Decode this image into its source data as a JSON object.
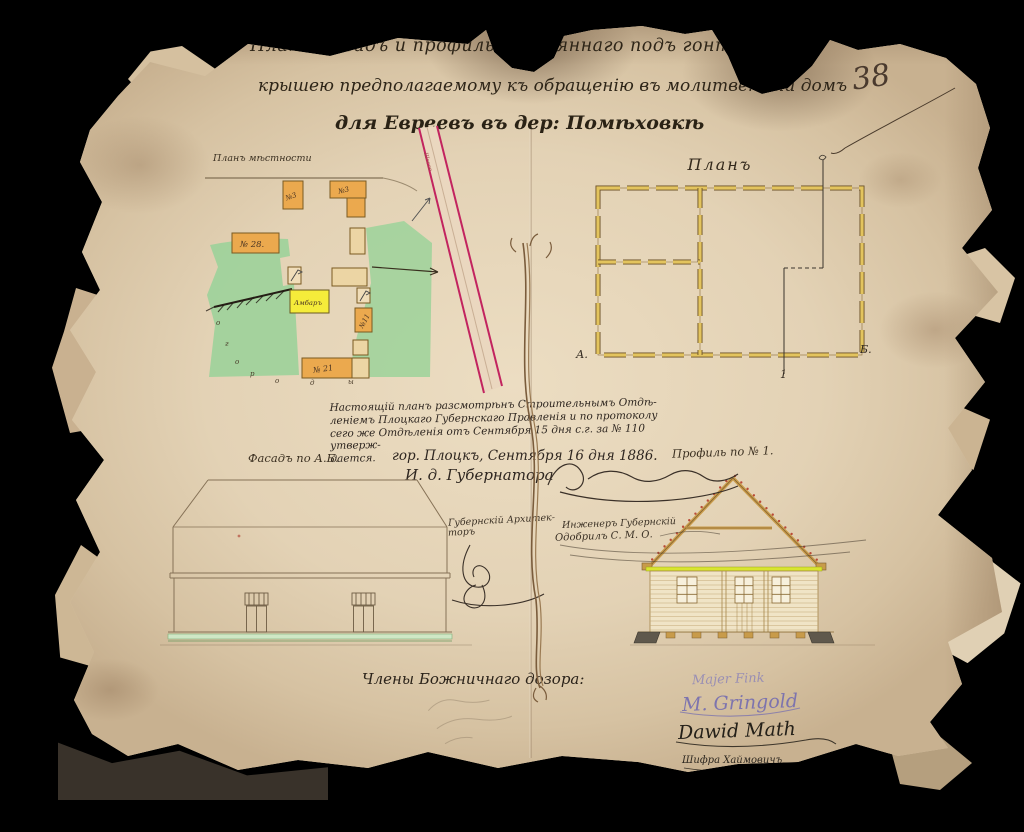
{
  "page": {
    "archive_number": "38",
    "title": {
      "line1": "Планъ фасадъ и профиль деревяннаго подъ гонтовою",
      "line2": "крышею предполагаемому къ обращенію въ молитвенный домъ",
      "line3": "для Евреевъ въ дер: Помѣховкѣ"
    },
    "site_plan": {
      "label": "Планъ мѣстности",
      "road_label": "Шоссе",
      "buildings": {
        "no3_left": "№3",
        "no3_right": "№3",
        "no28": "№ 28.",
        "barn": "Амбаръ",
        "no11": "№11",
        "no21": "№ 21"
      },
      "area_letters": [
        "о",
        "г",
        "о",
        "р",
        "о",
        "д",
        "ы"
      ]
    },
    "floor_plan": {
      "label": "Планъ",
      "corner_a": "А.",
      "corner_b": "Б.",
      "section_number": "1"
    },
    "approval": {
      "line1": "Настоящій планъ разсмотрѣнъ Строительнымъ Отдѣ-",
      "line2": "леніемъ Плоцкаго Губернскаго Правленія и по протоколу",
      "line3": "сего же Отдѣленія отъ Сентября 15 дня с.г. за № 110 утверж-",
      "line4": "дается.",
      "date_line": "гор. Плоцкъ, Сентября 16 дня 1886.",
      "governor_label": "И. д. Губернатора"
    },
    "facade": {
      "label": "Фасадъ по А.Б."
    },
    "profile": {
      "label": "Профиль по № 1."
    },
    "officials": {
      "architect_line1": "Губернскій Архитек-",
      "architect_line2": "торъ",
      "engineer_title": "Инженеръ Губернскій",
      "engineer_approved": "Одобрилъ С. М. О."
    },
    "signatures": {
      "heading": "Члены Божничнаго дозора:",
      "names": [
        "Majer Fink",
        "M. Gringold",
        "Dawid Math",
        "Шифра Хаймовичъ"
      ]
    }
  }
}
